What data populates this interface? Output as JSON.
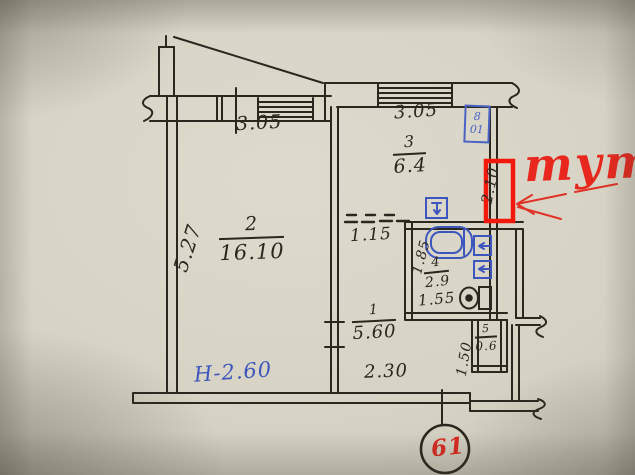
{
  "plan": {
    "rooms": [
      {
        "id": "1",
        "area": "5.60"
      },
      {
        "id": "2",
        "area": "16.10"
      },
      {
        "id": "3",
        "area": "6.4"
      },
      {
        "id": "4",
        "area": "2.9"
      },
      {
        "id": "5",
        "area": "0.6"
      }
    ],
    "dims": {
      "top_left_window": "3.05",
      "top_right_window": "3.05",
      "left_wall": "5.27",
      "right_wall": "2.10",
      "opening": "1.15",
      "bath_left": "1.85",
      "bath_width": "1.55",
      "hall_bottom": "2.30",
      "closet_left": "1.50"
    },
    "notes": {
      "ceiling_height": "Н-2.60"
    },
    "stamp": {
      "line1": "8",
      "line2": "01"
    },
    "apartment_number": "61"
  },
  "overlay": {
    "here_label": "тут"
  },
  "icons": {
    "bathtub-icon": "rounded-rect-tub",
    "sink-icon": "blue-box-arrow",
    "boiler-icon": "blue-box-arrow",
    "stove-icon": "blue-box-arrow",
    "toilet-icon": "tank-and-bowl",
    "window-icon": "parallel-lines"
  },
  "colors": {
    "paper": "#d6d3c5",
    "ink": "#2b261e",
    "blue_ink": "#3d56bd",
    "red_marker": "#f2190c",
    "red_text": "#e8281e"
  }
}
